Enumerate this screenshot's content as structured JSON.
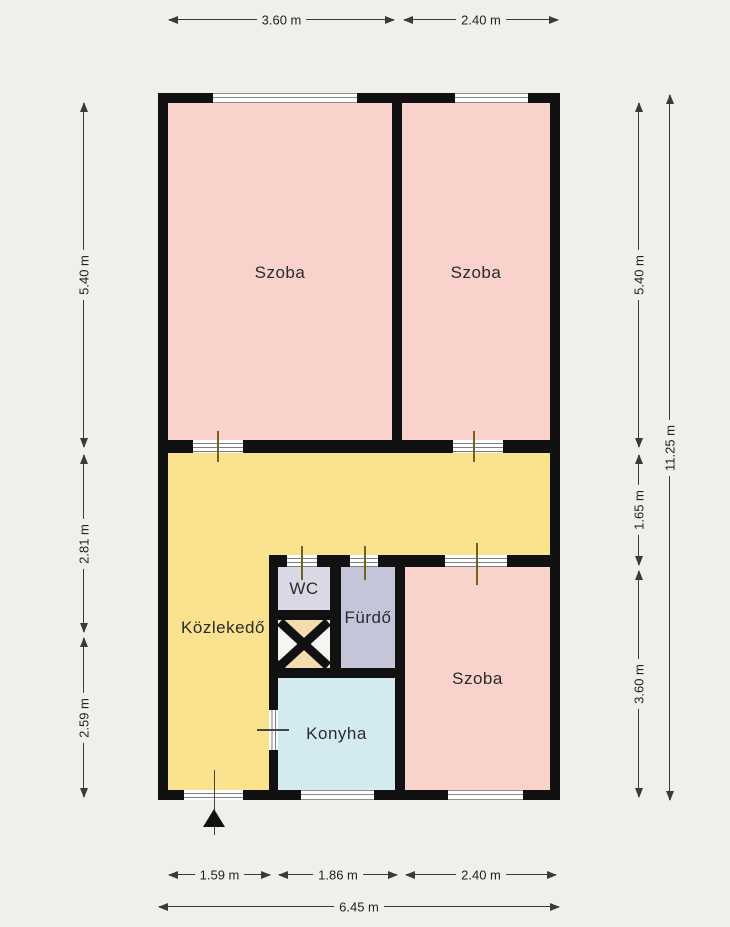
{
  "plan": {
    "rooms": [
      {
        "id": "szoba-top-left",
        "label": "Szoba",
        "color": "#f9d2cb"
      },
      {
        "id": "szoba-top-right",
        "label": "Szoba",
        "color": "#f9d2cb"
      },
      {
        "id": "kozlekedo",
        "label": "Közlekedő",
        "color": "#fae28e"
      },
      {
        "id": "wc",
        "label": "WC",
        "color": "#d9d9e5"
      },
      {
        "id": "furdo",
        "label": "Fürdő",
        "color": "#c5c5da"
      },
      {
        "id": "konyha",
        "label": "Konyha",
        "color": "#d3eaf1"
      },
      {
        "id": "szoba-bottom-right",
        "label": "Szoba",
        "color": "#f9d2cb"
      }
    ],
    "colors": {
      "wall": "#111111",
      "background": "#f1efe9",
      "shaft_fill": "#f5dcae",
      "shaft_fill_alt": "#f7f5f1",
      "dimension_line": "#3a3a3a"
    }
  },
  "dimensions": {
    "top": [
      {
        "label": "3.60 m"
      },
      {
        "label": "2.40 m"
      }
    ],
    "left": [
      {
        "label": "5.40 m"
      },
      {
        "label": "2.81 m"
      },
      {
        "label": "2.59 m"
      }
    ],
    "right_inner": [
      {
        "label": "5.40 m"
      },
      {
        "label": "1.65 m"
      },
      {
        "label": "3.60 m"
      }
    ],
    "right_outer": [
      {
        "label": "11.25 m"
      }
    ],
    "bottom_inner": [
      {
        "label": "1.59 m"
      },
      {
        "label": "1.86 m"
      },
      {
        "label": "2.40 m"
      }
    ],
    "bottom_outer": [
      {
        "label": "6.45 m"
      }
    ]
  }
}
